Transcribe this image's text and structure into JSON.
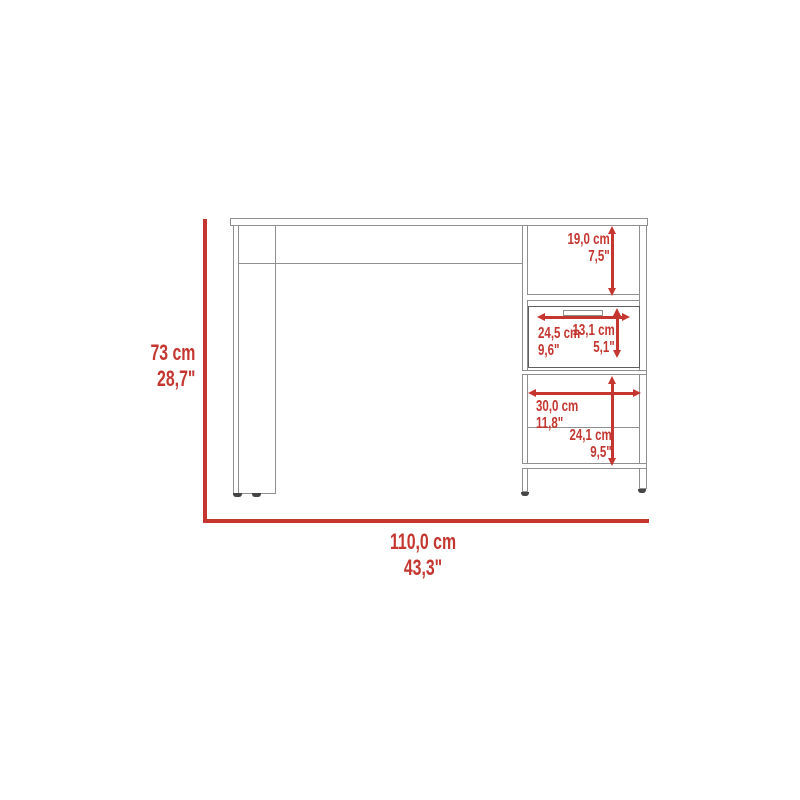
{
  "diagram": {
    "kind": "desk-dimension-drawing",
    "dims": {
      "height": {
        "cm": "73 cm",
        "inch": "28,7\""
      },
      "width": {
        "cm": "110,0 cm",
        "inch": "43,3\""
      },
      "top_shelf": {
        "cm": "19,0 cm",
        "inch": "7,5\""
      },
      "drawer_w": {
        "cm": "24,5 cm",
        "inch": "9,6\""
      },
      "drawer_h": {
        "cm": "13,1 cm",
        "inch": "5,1\""
      },
      "shelf_w": {
        "cm": "30,0 cm",
        "inch": "11,8\""
      },
      "shelf_h": {
        "cm": "24,1 cm",
        "inch": "9,5\""
      }
    }
  },
  "colors": {
    "dimension_red": "#c4362f",
    "line_gray": "#8f8f8f",
    "drawer_gray": "#5f5f5f",
    "foot_dark": "#454545",
    "background": "#ffffff"
  }
}
